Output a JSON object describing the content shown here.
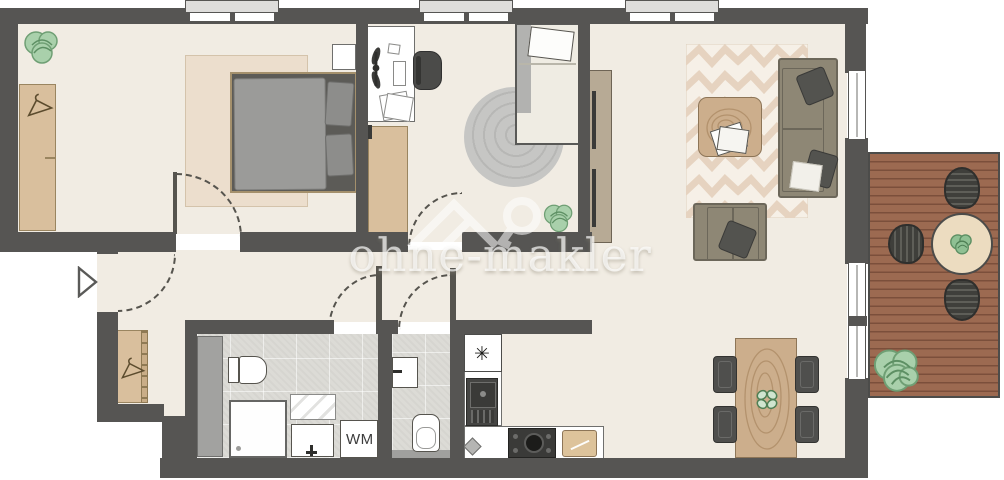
{
  "watermark": {
    "text": "ohne-makler",
    "logo": "ohne-makler-house-key-logo"
  },
  "labels": {
    "washing_machine": "WM",
    "fridge_symbol": "✳"
  },
  "colors": {
    "wall": "#565553",
    "floor": "#f1ece3",
    "tile": "#dcdbd6",
    "wood_furniture": "#d9bf9d",
    "sofa": "#8e8775",
    "deck": "#9c6a51",
    "plant": "#9fc8a1",
    "rug_bedroom": "#ecdecd",
    "rug_chevron": "#e6d3c0"
  },
  "rooms": [
    {
      "name": "bedroom",
      "furniture": [
        "double-bed",
        "wardrobe",
        "rug",
        "plant",
        "nightstand"
      ]
    },
    {
      "name": "kids-room",
      "furniture": [
        "desk",
        "office-chair",
        "single-bed",
        "round-rug",
        "dresser",
        "plant"
      ]
    },
    {
      "name": "living-room",
      "furniture": [
        "sofa",
        "armchair",
        "coffee-table",
        "chevron-rug",
        "tall-cabinet",
        "dining-table",
        "dining-chairs"
      ]
    },
    {
      "name": "kitchen",
      "furniture": [
        "fridge",
        "sink",
        "stove",
        "cutting-board"
      ]
    },
    {
      "name": "bathroom",
      "furniture": [
        "toilet",
        "shower",
        "sink",
        "mirror",
        "washing-machine"
      ]
    },
    {
      "name": "wc",
      "furniture": [
        "toilet",
        "hand-basin"
      ]
    },
    {
      "name": "hallway",
      "furniture": [
        "wardrobe",
        "entrance-arrow"
      ]
    },
    {
      "name": "balcony",
      "furniture": [
        "round-table",
        "outdoor-chairs",
        "plant",
        "wood-deck"
      ]
    }
  ]
}
